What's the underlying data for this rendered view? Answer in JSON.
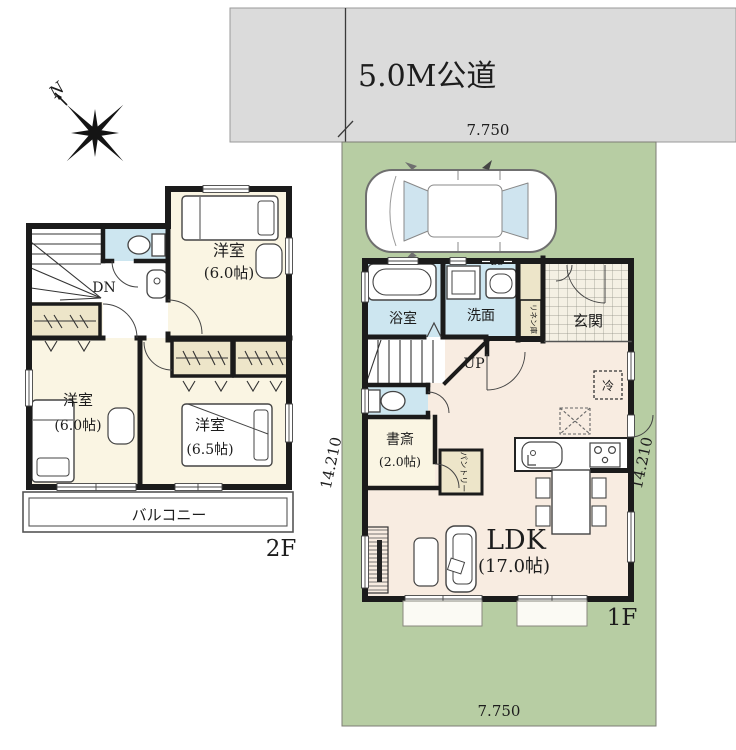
{
  "site": {
    "road_label": "5.0M公道",
    "dim_top": "7.750",
    "dim_bottom": "7.750",
    "dim_left": "14.210",
    "dim_right": "14.210",
    "compass_n": "N"
  },
  "floor1": {
    "label": "1F",
    "stair": "UP",
    "bath": "浴室",
    "washroom": "洗面",
    "entrance": "玄関",
    "linen": "リネン庫",
    "meter": "BS",
    "fridge": "冷",
    "pantry": "パントリー",
    "study": {
      "name": "書斎",
      "area": "(2.0帖)"
    },
    "ldk": {
      "name": "LDK",
      "area": "(17.0帖)"
    }
  },
  "floor2": {
    "label": "2F",
    "stair": "DN",
    "balcony": "バルコニー",
    "bedroom_a": {
      "name": "洋室",
      "area": "(6.0帖)"
    },
    "bedroom_b": {
      "name": "洋室",
      "area": "(6.0帖)"
    },
    "bedroom_c": {
      "name": "洋室",
      "area": "(6.5帖)"
    }
  },
  "colors": {
    "road": "#dbdbdb",
    "lot": "#b7cda3",
    "wall": "#1b1b1b",
    "wet": "#cde6f0",
    "room": "#faf5e3",
    "ldk_floor": "#f8ece1",
    "closet": "#ede5c9",
    "tile": "#f4f0e4"
  }
}
